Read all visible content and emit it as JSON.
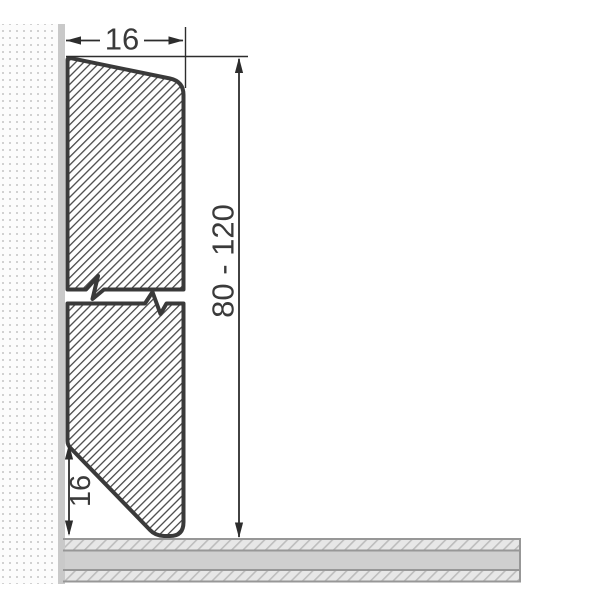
{
  "drawing": {
    "type": "skirting-board-profile-cross-section",
    "dimensions": {
      "top_width": {
        "label": "16"
      },
      "height_range": {
        "label": "80 - 120"
      },
      "bottom_bevel_height": {
        "label": "16"
      }
    },
    "colors": {
      "background": "#ffffff",
      "dimension_lines": "#2d2d2d",
      "text": "#3a3a3a",
      "profile_outline": "#3a3a3a",
      "profile_hatch_lines": "#4a4a4a",
      "wall_face_strip": "#c9c9c9",
      "wall_dots": "#d1d1d1",
      "wall_background": "#fcfcfc",
      "floor_core_band": "#cfcfcf",
      "floor_hatch_background": "#e7e7e7",
      "floor_hatch_lines": "#bdbdbd",
      "floor_border": "#979797"
    }
  }
}
